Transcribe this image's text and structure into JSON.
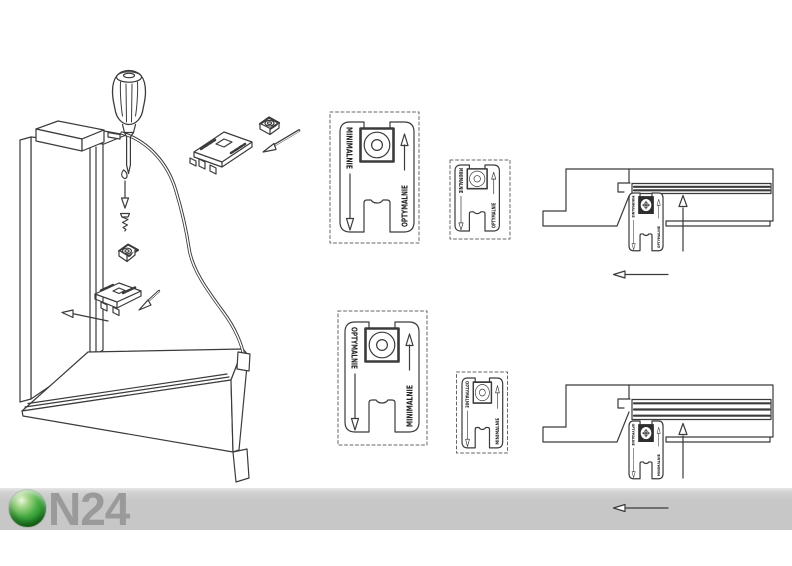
{
  "branding": {
    "logo_text": "N24"
  },
  "labels": {
    "minimal": "MINIMALNIE",
    "optimal": "OPTYMALNIE"
  },
  "panels": {
    "step1": {
      "left": "MINIMALNIE",
      "right": "OPTYMALNIE"
    },
    "step2": {
      "left": "OPTYMALNIE",
      "right": "MINIMALNIE"
    }
  },
  "cross_sections": {
    "top": {
      "left": "MINIMALNIE",
      "right": "OPTYMALNIE"
    },
    "bottom": {
      "left": "OPTYMALNIE",
      "right": "MINIMALNIE"
    }
  },
  "colors": {
    "line": "#3b3b3b",
    "strip": "#c8c8c8",
    "logo_text": "#9a9a9a",
    "logo_green": "#2f9a33"
  }
}
